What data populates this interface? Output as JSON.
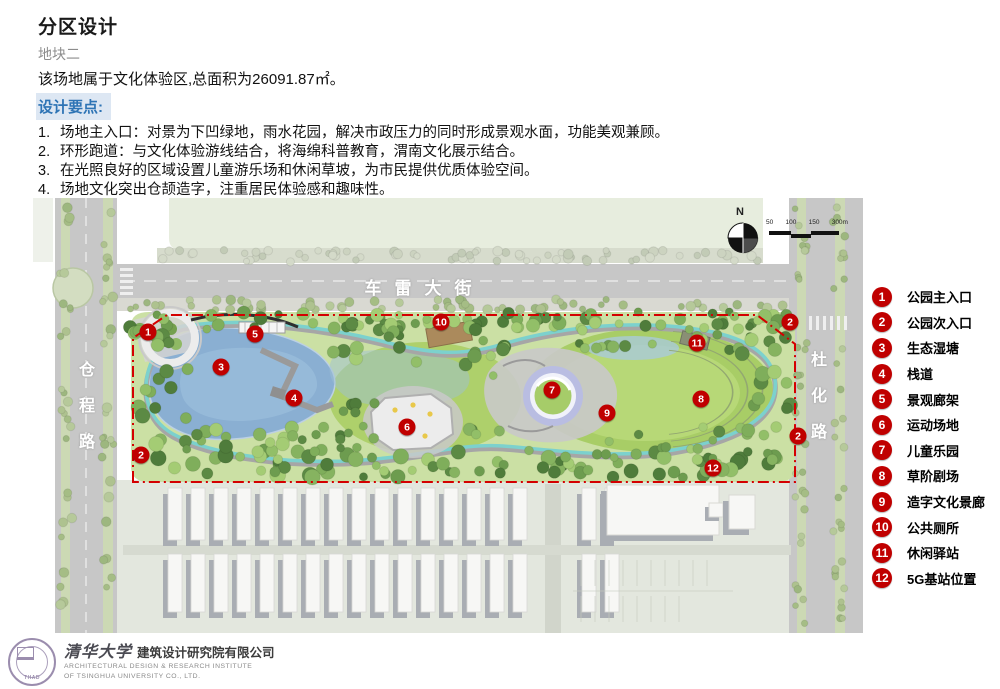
{
  "header": {
    "title": "分区设计",
    "subtitle": "地块二",
    "intro": "该场地属于文化体验区,总面积为26091.87㎡。",
    "section_label": "设计要点:"
  },
  "design_points": [
    {
      "num": "1.",
      "text": "场地主入口：对景为下凹绿地，雨水花园，解决市政压力的同时形成景观水面，功能美观兼顾。"
    },
    {
      "num": "2.",
      "text": "环形跑道：与文化体验游线结合，将海绵科普教育，渭南文化展示结合。"
    },
    {
      "num": "3.",
      "text": "在光照良好的区域设置儿童游乐场和休闲草坡，为市民提供优质体验空间。"
    },
    {
      "num": "4.",
      "text": "场地文化突出仓颉造字，注重居民体验感和趣味性。"
    }
  ],
  "map": {
    "street_top": "车雷大街",
    "street_left": [
      "仓",
      "程",
      "路"
    ],
    "street_right": [
      "杜",
      "化",
      "路"
    ],
    "north_label": "N",
    "scale_ticks": [
      "50",
      "100",
      "150",
      "300m"
    ],
    "markers": [
      {
        "num": "1",
        "x": 115,
        "y": 134
      },
      {
        "num": "5",
        "x": 222,
        "y": 136
      },
      {
        "num": "10",
        "x": 408,
        "y": 124
      },
      {
        "num": "3",
        "x": 188,
        "y": 169
      },
      {
        "num": "4",
        "x": 261,
        "y": 200
      },
      {
        "num": "7",
        "x": 519,
        "y": 192
      },
      {
        "num": "9",
        "x": 574,
        "y": 215
      },
      {
        "num": "8",
        "x": 668,
        "y": 201
      },
      {
        "num": "11",
        "x": 664,
        "y": 145
      },
      {
        "num": "6",
        "x": 374,
        "y": 229
      },
      {
        "num": "2",
        "x": 108,
        "y": 257
      },
      {
        "num": "2",
        "x": 757,
        "y": 124
      },
      {
        "num": "2",
        "x": 765,
        "y": 238
      },
      {
        "num": "12",
        "x": 680,
        "y": 270
      }
    ]
  },
  "legend": {
    "items": [
      {
        "num": "1",
        "label": "公园主入口"
      },
      {
        "num": "2",
        "label": "公园次入口"
      },
      {
        "num": "3",
        "label": "生态湿塘"
      },
      {
        "num": "4",
        "label": "栈道"
      },
      {
        "num": "5",
        "label": "景观廊架"
      },
      {
        "num": "6",
        "label": "运动场地"
      },
      {
        "num": "7",
        "label": "儿童乐园"
      },
      {
        "num": "8",
        "label": "草阶剧场"
      },
      {
        "num": "9",
        "label": "造字文化景廊"
      },
      {
        "num": "10",
        "label": "公共厕所"
      },
      {
        "num": "11",
        "label": "休闲驿站"
      },
      {
        "num": "12",
        "label": "5G基站位置"
      }
    ]
  },
  "colors": {
    "accent_blue": "#2e74b5",
    "marker_red": "#c00000",
    "boundary_red": "#d40000"
  },
  "footer": {
    "seal_text": "THAD",
    "cn_name": "清华大学",
    "cn_company": "建筑设计研究院有限公司",
    "en_line1": "ARCHITECTURAL DESIGN & RESEARCH INSTITUTE",
    "en_line2": "OF TSINGHUA UNIVERSITY CO., LTD."
  }
}
